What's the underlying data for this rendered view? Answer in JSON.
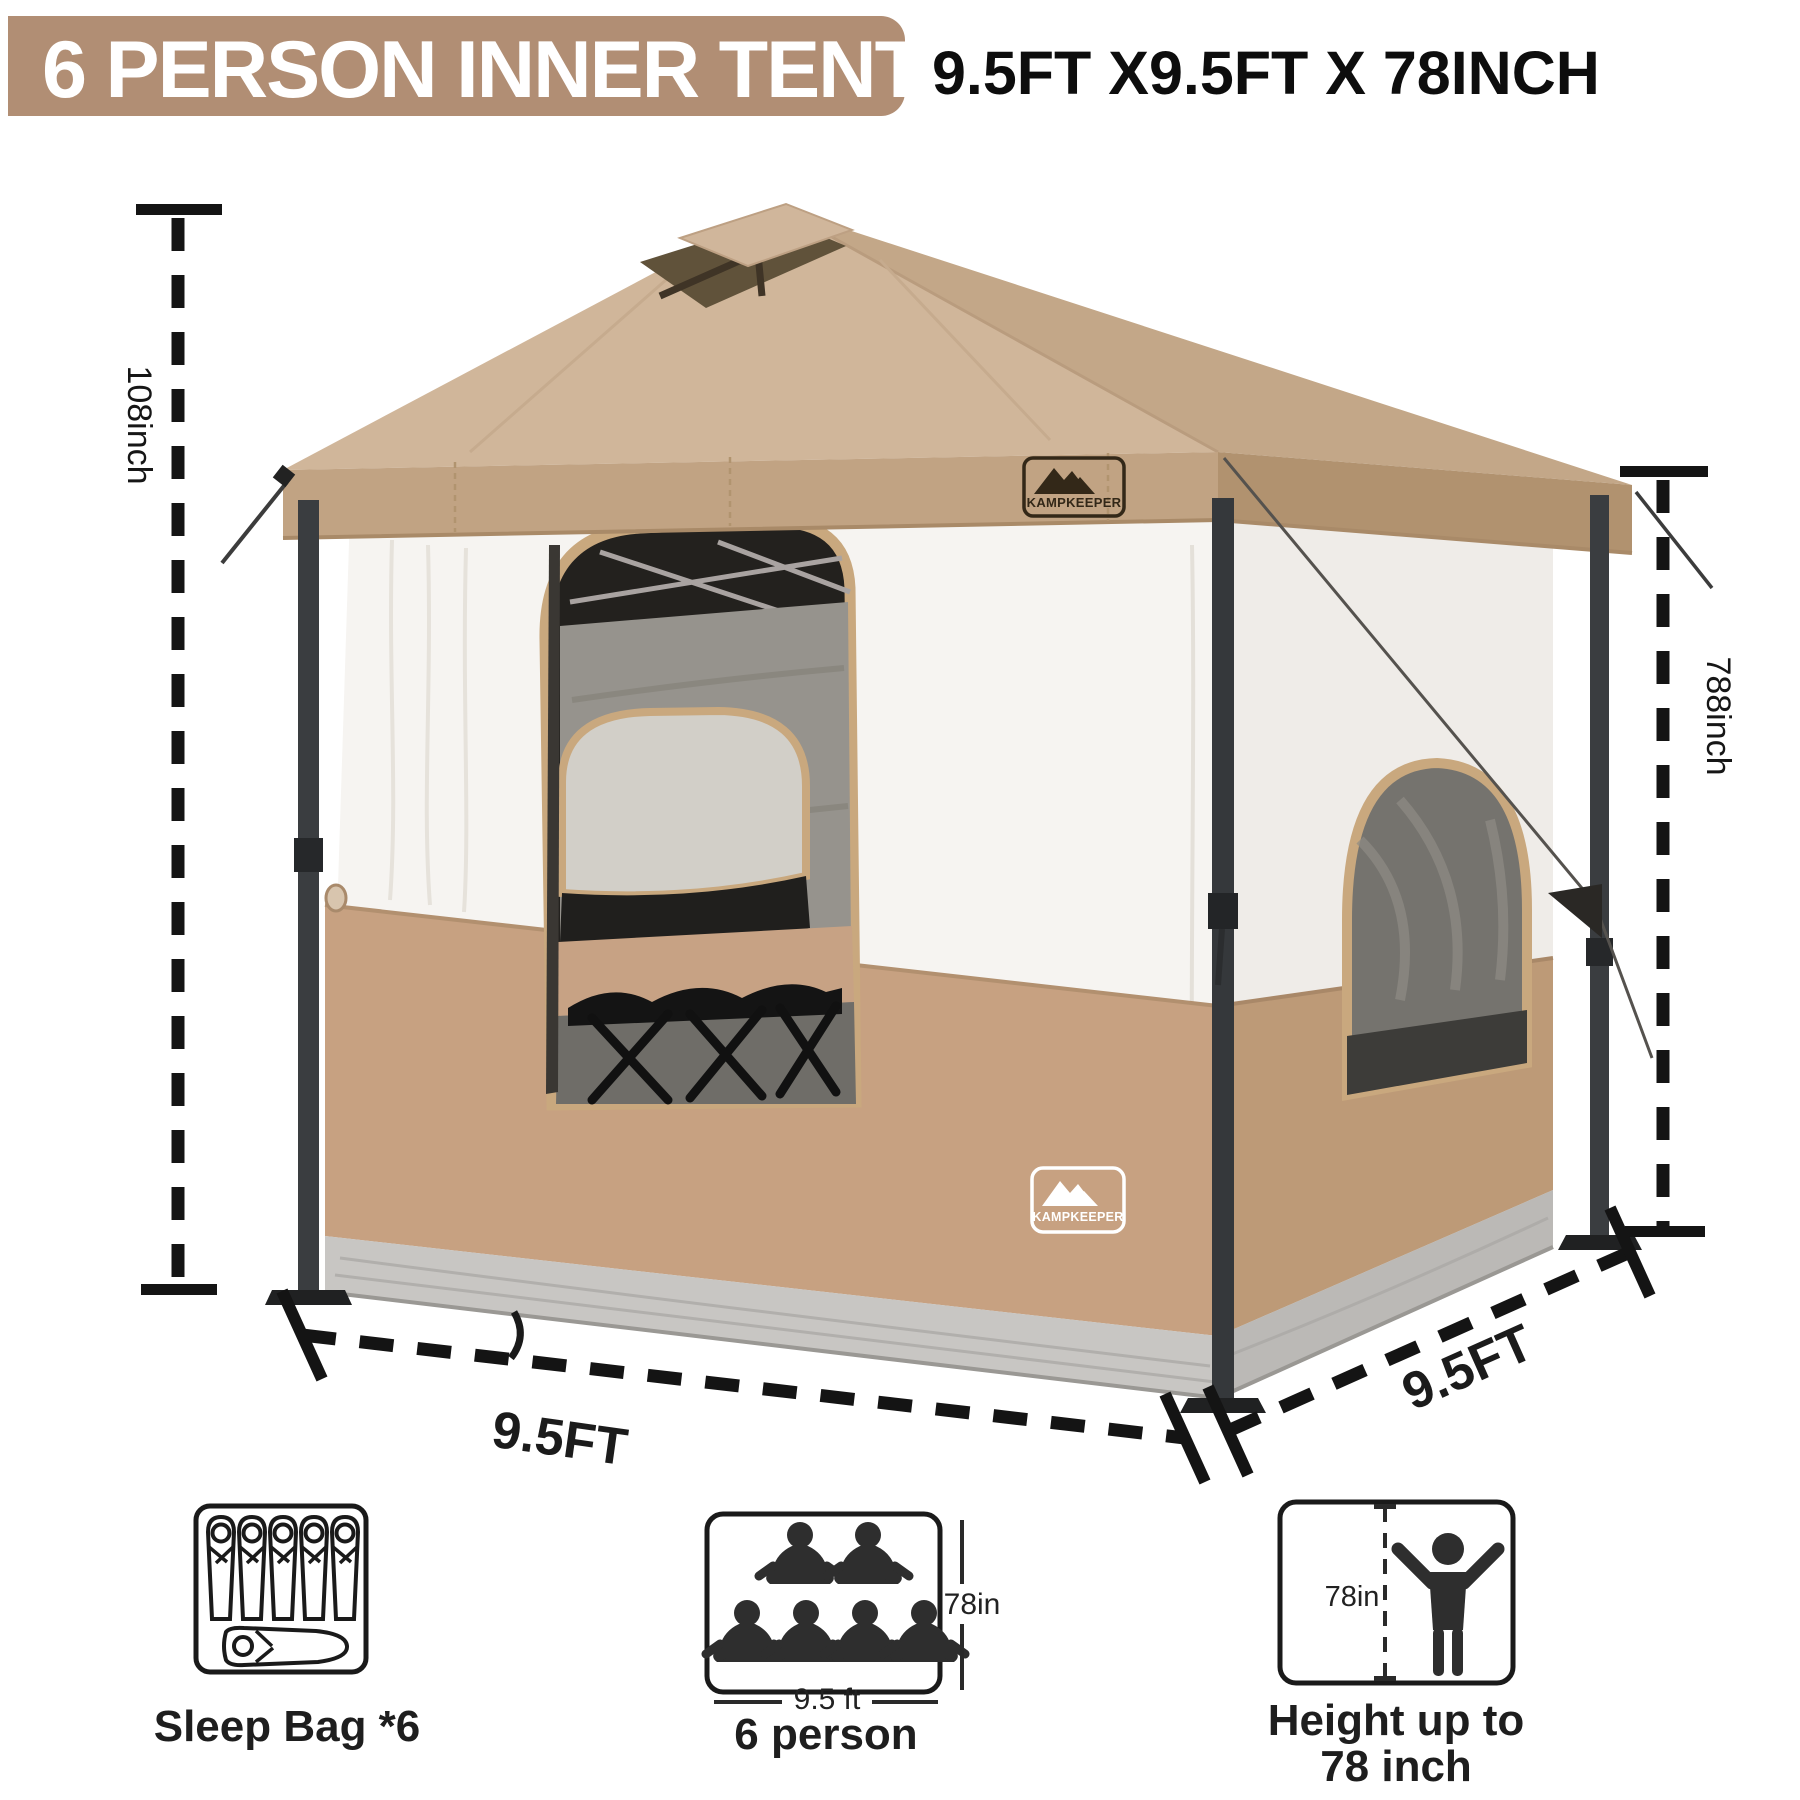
{
  "header": {
    "title": "6 PERSON INNER TENT",
    "size_text": "9.5FT X9.5FT X 78INCH"
  },
  "brand": {
    "name": "KAMPKEEPER"
  },
  "dimensions": {
    "canopy_height": "108inch",
    "inner_height": "788inch",
    "front_width": "9.5FT",
    "side_depth": "9.5FT"
  },
  "features": {
    "sleep_bag": {
      "label": "Sleep Bag *6"
    },
    "capacity": {
      "label": "6 person",
      "width_note": "9.5 ft",
      "height_note": "78in"
    },
    "standing_height": {
      "label_line1": "Height up to",
      "label_line2": "78 inch",
      "height_note": "78in"
    }
  },
  "colors": {
    "banner": "#b18e74",
    "canopy_front": "#d0b69a",
    "canopy_side": "#c3a788",
    "trim": "#c9a87e",
    "dimension_line": "#141414"
  }
}
